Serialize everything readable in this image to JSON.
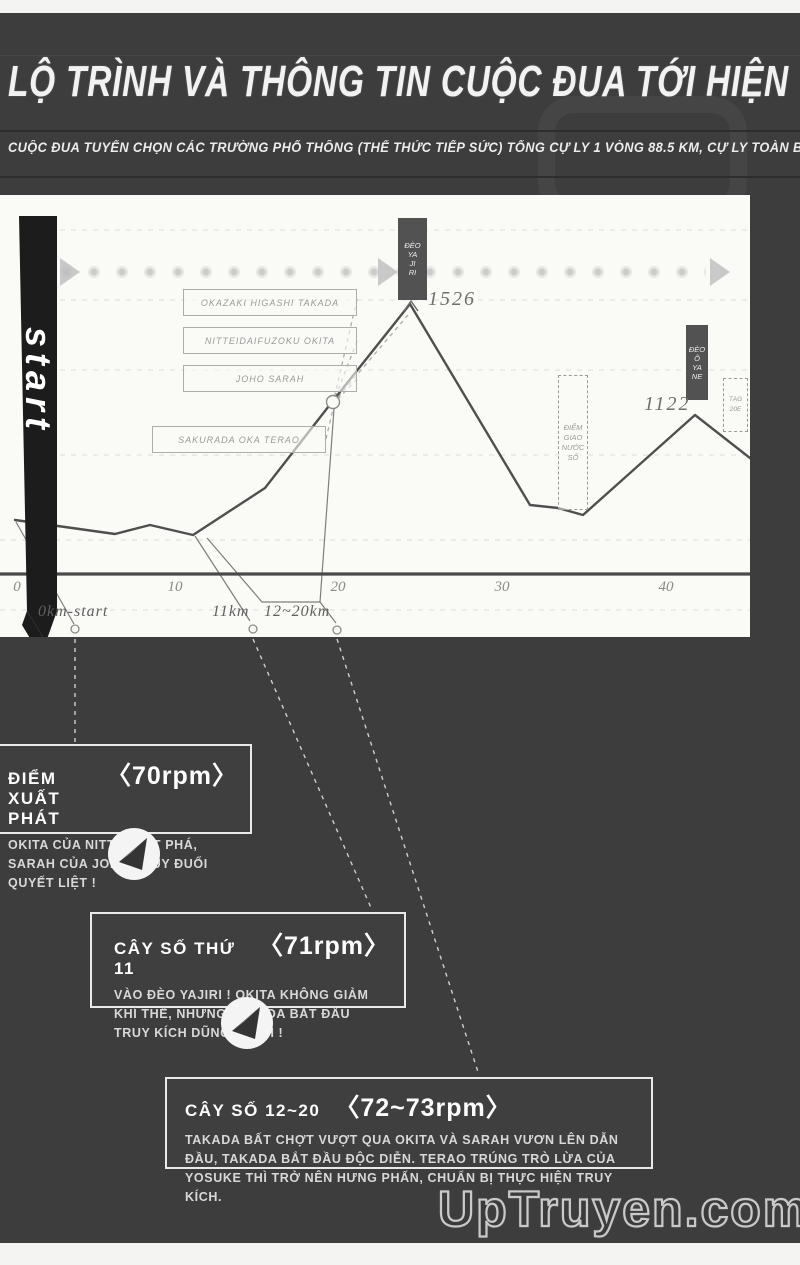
{
  "header": {
    "title": "LỘ TRÌNH VÀ THÔNG TIN CUỘC ĐUA TỚI HIỆN TẠI",
    "subtitle": "CUỘC ĐUA TUYỂN CHỌN CÁC TRƯỜNG PHỔ THÔNG (THỂ THỨC TIẾP SỨC) TỔNG CỰ LY 1 VÒNG 88.5 KM, CỰ LY TOÀN BỘ (4 VÒNG) 354 KM"
  },
  "chart": {
    "start_label": "start",
    "runner_labels": [
      "OKAZAKI HIGASHI TAKADA",
      "NITTEIDAIFUZOKU OKITA",
      "JOHO SARAH",
      "SAKURADA OKA TERAO"
    ],
    "pass1": {
      "lines": [
        "ĐÈO",
        "YA",
        "JI",
        "RI"
      ],
      "elevation": "1526"
    },
    "pass2": {
      "lines": [
        "ĐÈO",
        "Ô",
        "YA",
        "NE"
      ],
      "elevation": "1122"
    },
    "water_station": {
      "lines": [
        "ĐIỂM",
        "GIAO",
        "NƯỚC",
        "SỐ"
      ]
    },
    "side_marker": {
      "lines": [
        "TẠG",
        "20E"
      ]
    },
    "x_ticks": [
      "0",
      "10",
      "20",
      "30",
      "40"
    ],
    "milestones": [
      "0km-start",
      "11km",
      "12~20km"
    ]
  },
  "callouts": [
    {
      "title": "ĐIỂM XUẤT PHÁT",
      "rpm": "〈70rpm〉",
      "body": "OKITA CỦA NITTEI BỨT PHÁ, SARAH CỦA JOHO TRUY ĐUỔI QUYẾT LIỆT !"
    },
    {
      "title": "CÂY SỐ THỨ 11",
      "rpm": "〈71rpm〉",
      "body": "VÀO ĐÈO YAJIRI ! OKITA KHÔNG GIẢM KHÍ THẾ, NHƯNG TAKADA BẮT ĐẦU TRUY KÍCH DŨNG MÃNH !"
    },
    {
      "title": "CÂY SỐ 12~20",
      "rpm": "〈72~73rpm〉",
      "body": "TAKADA BẤT CHỢT VƯỢT QUA OKITA VÀ SARAH VƯƠN LÊN DẪN ĐẦU, TAKADA BẮT ĐẦU ĐỘC DIỄN. TERAO TRÚNG TRÒ LỪA CỦA YOSUKE THÌ TRỞ NÊN HƯNG PHẤN, CHUẨN BỊ THỰC HIỆN TRUY KÍCH."
    }
  ],
  "watermark": {
    "text": "UpTruyen.com"
  },
  "colors": {
    "page_bg": "#3d3d3d",
    "panel_bg": "#fafaf7",
    "profile_line": "#4f4f4f",
    "banner_bg": "#525252",
    "callout_border": "#e9e9e9"
  },
  "chart_data": {
    "type": "line",
    "title": "Course elevation profile (one lap 88.5 km, shown 0–45 km)",
    "xlabel": "distance (km)",
    "ylabel": "elevation (m)",
    "xlim": [
      0,
      45
    ],
    "x_ticks": [
      0,
      10,
      20,
      30,
      40
    ],
    "grid": "faint dashed horizontal",
    "legend": false,
    "series": [
      {
        "name": "elevation",
        "x": [
          0,
          6,
          8,
          11,
          15,
          19,
          24,
          32,
          35,
          41.5,
          45
        ],
        "y": [
          740,
          690,
          720,
          685,
          855,
          1165,
          1526,
          795,
          760,
          1122,
          965
        ]
      }
    ],
    "annotations": [
      {
        "x": 24,
        "y": 1526,
        "label": "1526 (Đèo Yajiri)"
      },
      {
        "x": 41.5,
        "y": 1122,
        "label": "1122 (Đèo Ôyane)"
      },
      {
        "x": 0,
        "label": "0km-start"
      },
      {
        "x": 11,
        "label": "11km"
      },
      {
        "x_range": [
          12,
          20
        ],
        "label": "12~20km"
      },
      {
        "x": 34,
        "label": "Điểm giao nước số (water station)"
      }
    ]
  }
}
